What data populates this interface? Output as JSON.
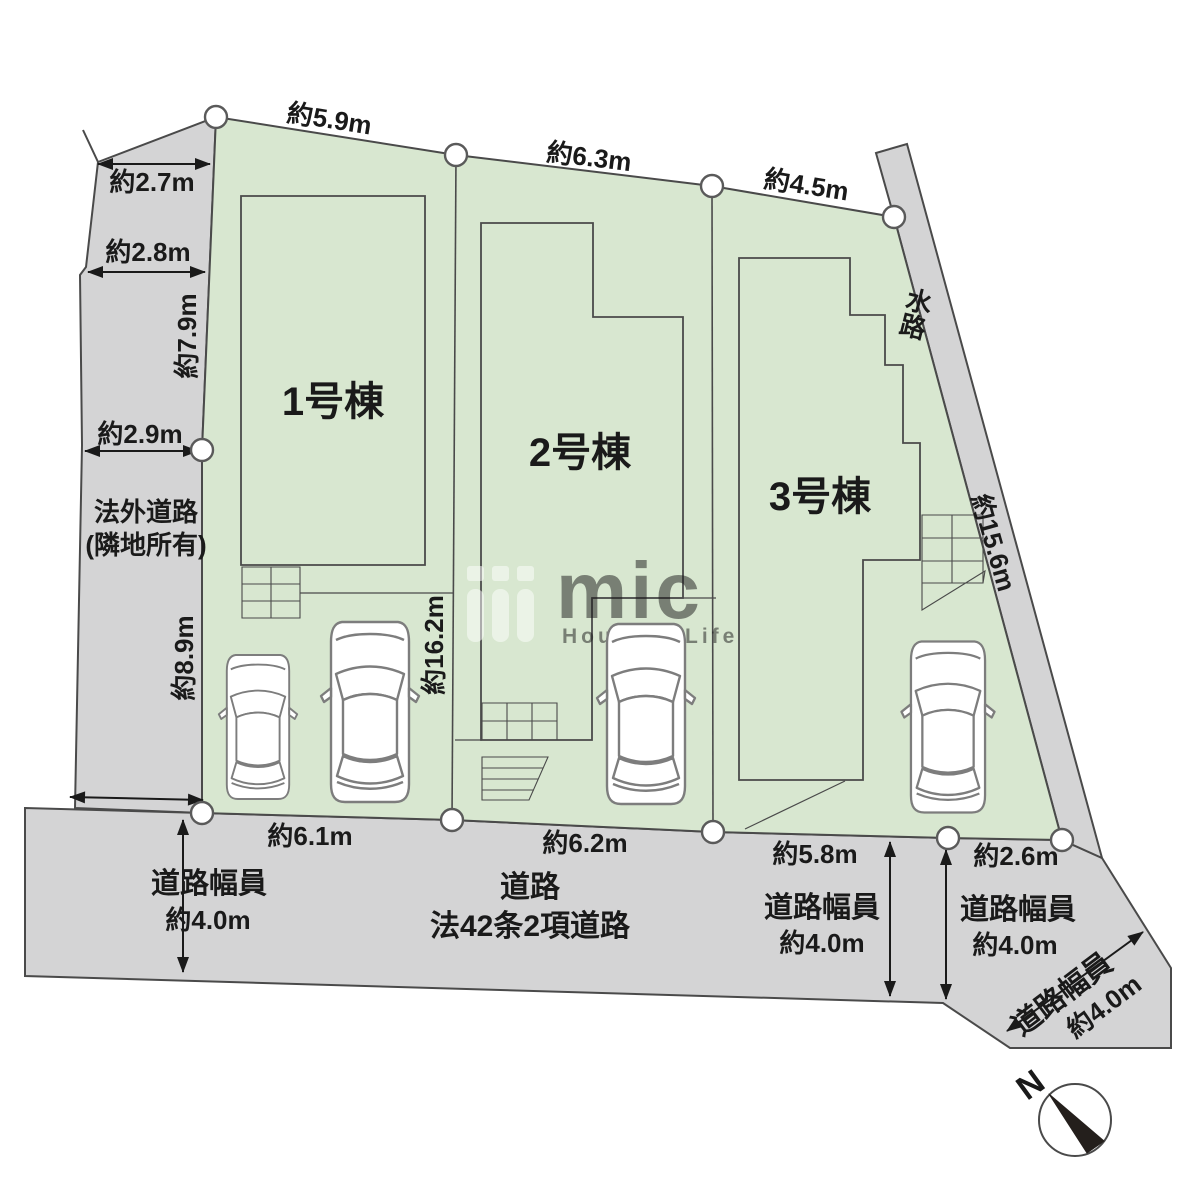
{
  "site_plan": {
    "buildings": [
      {
        "name": "1号棟"
      },
      {
        "name": "2号棟"
      },
      {
        "name": "3号棟"
      }
    ],
    "top_dimensions": [
      "約5.9m",
      "約6.3m",
      "約4.5m"
    ],
    "left_dimensions": [
      "約2.7m",
      "約2.8m",
      "約7.9m",
      "約2.9m",
      "約8.9m"
    ],
    "left_road": {
      "line1": "法外道路",
      "line2": "(隣地所有)"
    },
    "center_dimension": "約16.2m",
    "waterway": {
      "label": "水路",
      "dimension": "約15.6m"
    },
    "bottom_dimensions": [
      "約6.1m",
      "約6.2m",
      "約5.8m",
      "約2.6m"
    ],
    "main_road": {
      "line1": "道路",
      "line2": "法42条2項道路"
    },
    "road_sections": [
      {
        "label": "道路幅員",
        "value": "約4.0m"
      },
      {
        "label": "道路幅員",
        "value": "約4.0m"
      },
      {
        "label": "道路幅員",
        "value": "約4.0m"
      },
      {
        "label": "道路幅員",
        "value": "約4.0m"
      }
    ],
    "compass": {
      "north_label": "N"
    },
    "watermark": {
      "brand": "mic",
      "tagline": "House & Life"
    },
    "colors": {
      "lot_green": "#d8e7d0",
      "road_gray": "#d4d4d5",
      "outline": "#4a4a4a"
    }
  }
}
